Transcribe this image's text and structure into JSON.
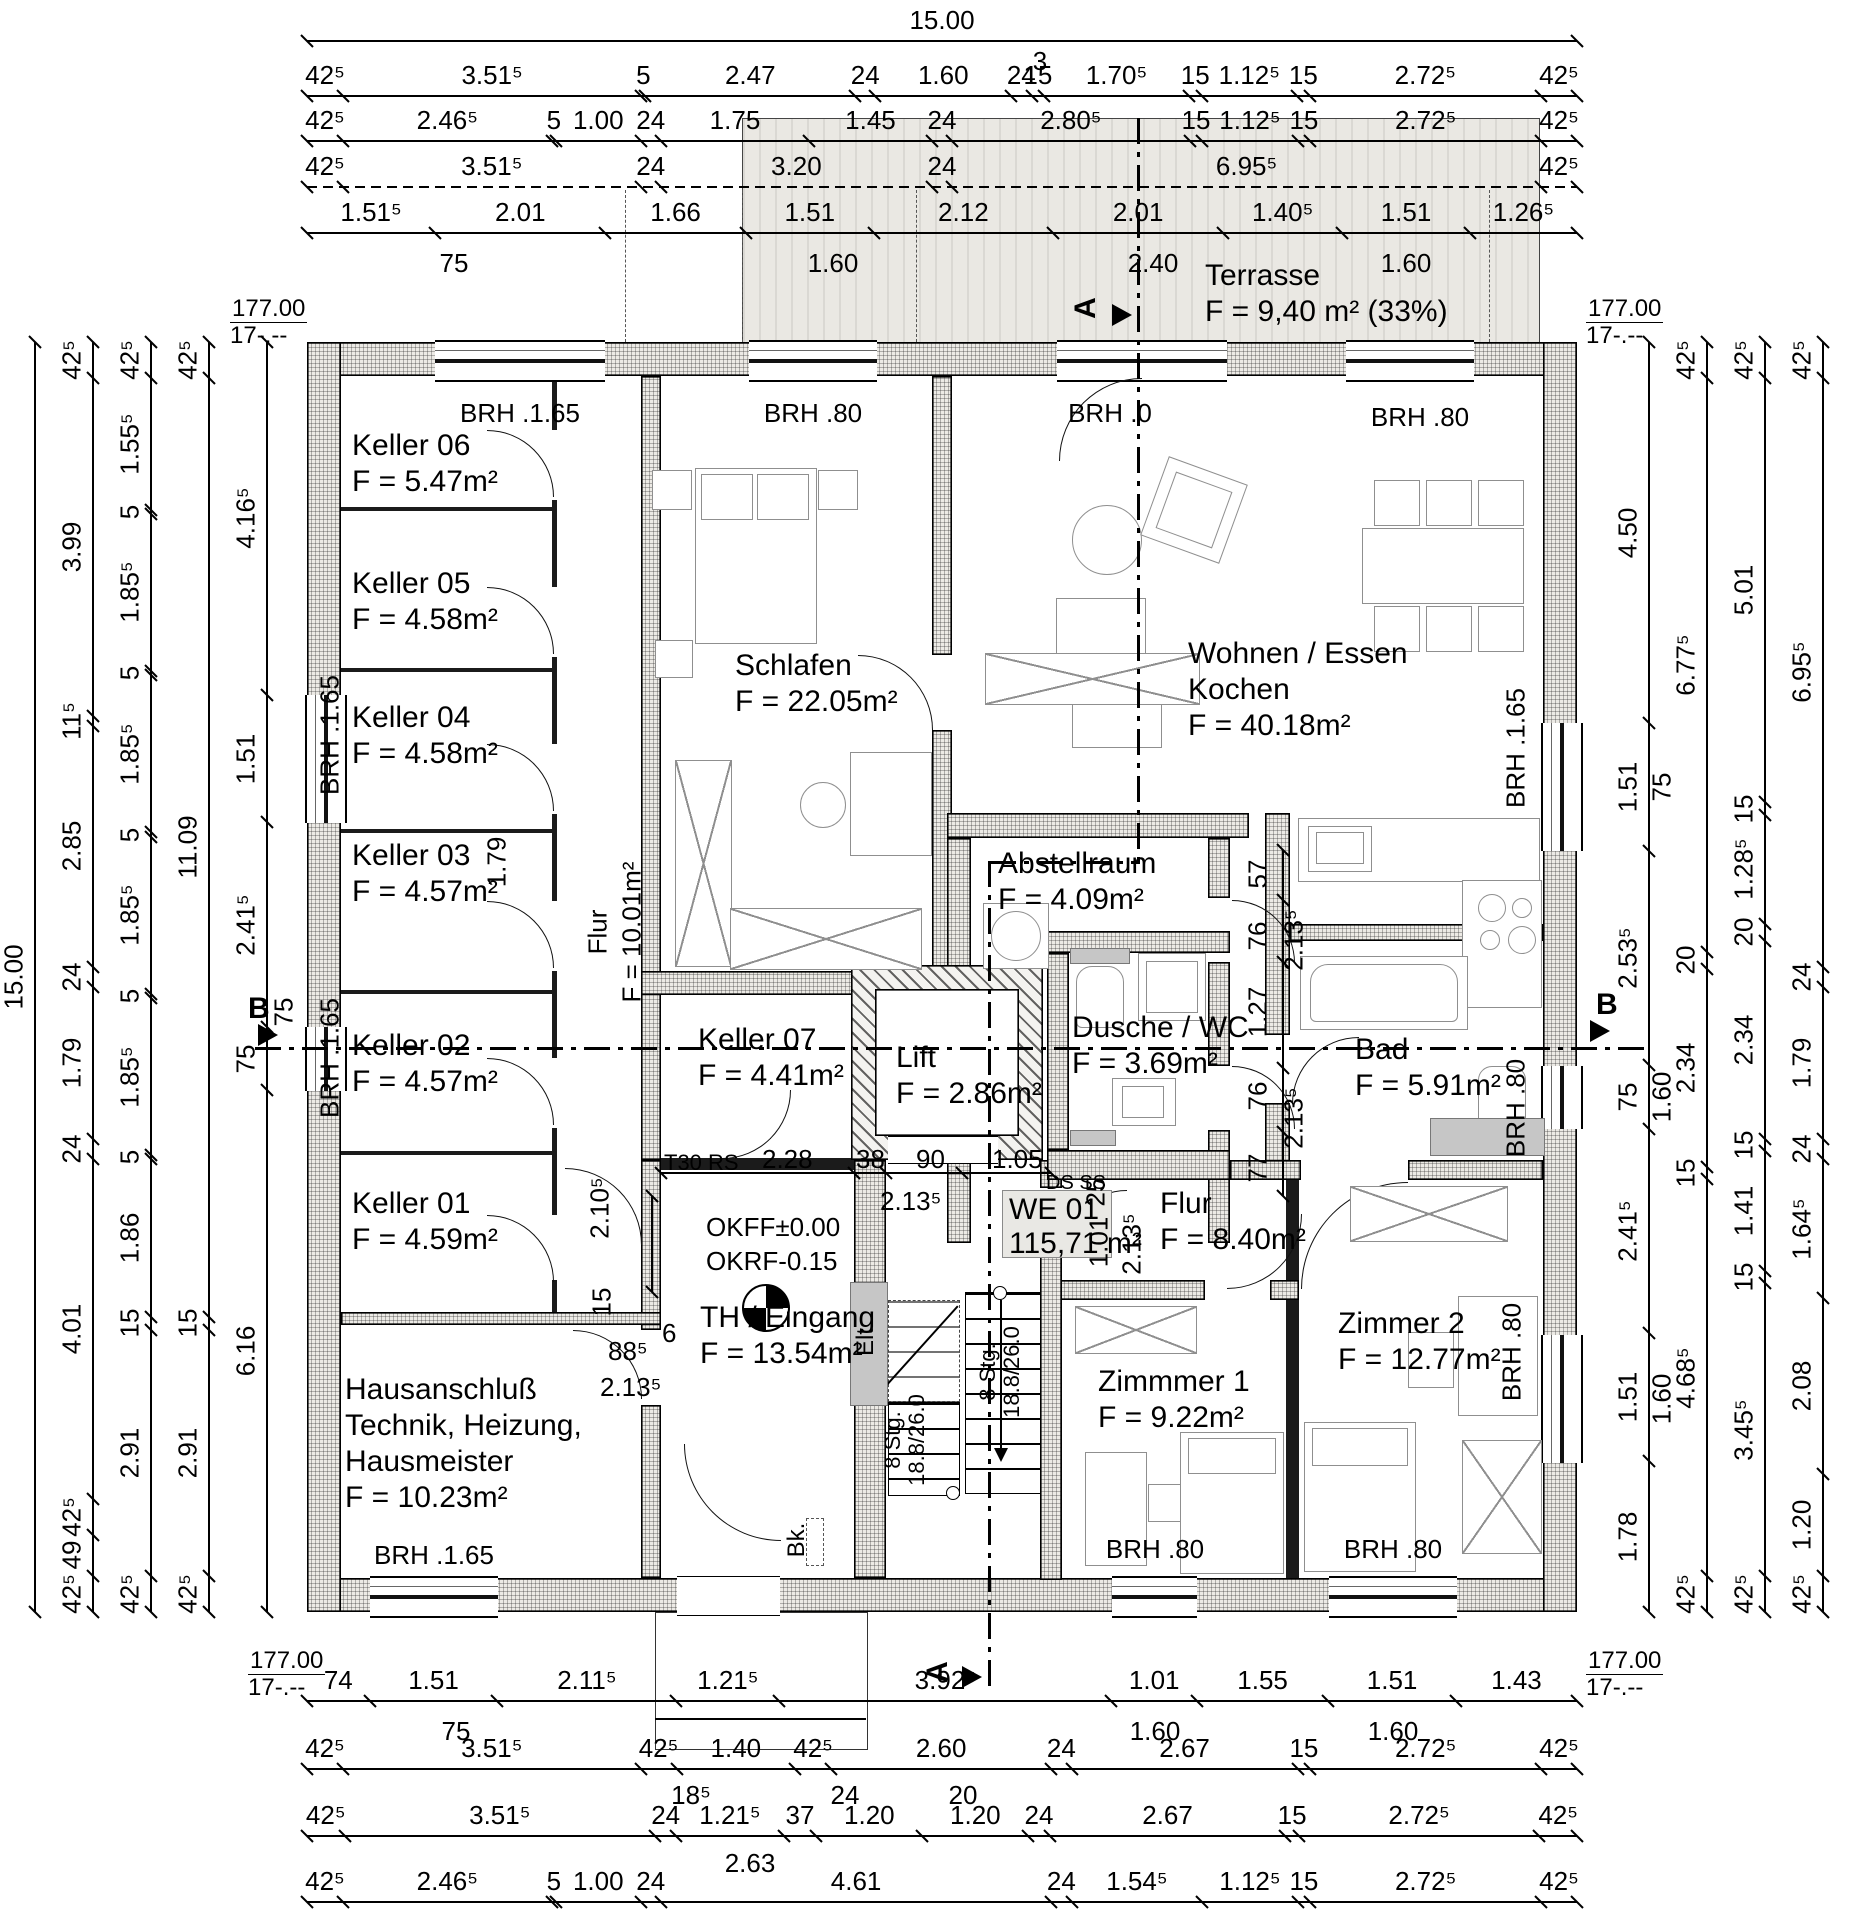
{
  "title": "Grundriss Erdgeschoss WE 01",
  "apartment_box": {
    "lines": [
      "WE 01",
      "115,71 m²"
    ]
  },
  "rooms": [
    {
      "id": "keller06",
      "lines": [
        "Keller 06",
        "F = 5.47m²"
      ],
      "x": 352,
      "y": 428
    },
    {
      "id": "keller05",
      "lines": [
        "Keller 05",
        "F = 4.58m²"
      ],
      "x": 352,
      "y": 566
    },
    {
      "id": "keller04",
      "lines": [
        "Keller 04",
        "F = 4.58m²"
      ],
      "x": 352,
      "y": 700
    },
    {
      "id": "keller03",
      "lines": [
        "Keller 03",
        "F = 4.57m²"
      ],
      "x": 352,
      "y": 838
    },
    {
      "id": "keller02",
      "lines": [
        "Keller 02",
        "F = 4.57m²"
      ],
      "x": 352,
      "y": 1028
    },
    {
      "id": "keller01",
      "lines": [
        "Keller 01",
        "F = 4.59m²"
      ],
      "x": 352,
      "y": 1186
    },
    {
      "id": "hausanschluss",
      "lines": [
        "Hausanschluß",
        "Technik, Heizung,",
        "Hausmeister",
        "F = 10.23m²"
      ],
      "x": 345,
      "y": 1372
    },
    {
      "id": "schlafen",
      "lines": [
        "Schlafen",
        "F = 22.05m²"
      ],
      "x": 735,
      "y": 648
    },
    {
      "id": "wohnen",
      "lines": [
        "Wohnen / Essen",
        "Kochen",
        "F = 40.18m²"
      ],
      "x": 1188,
      "y": 636
    },
    {
      "id": "abstellraum",
      "lines": [
        "Abstellraum",
        "F = 4.09m²"
      ],
      "x": 998,
      "y": 846
    },
    {
      "id": "keller07",
      "lines": [
        "Keller 07",
        "F = 4.41m²"
      ],
      "x": 698,
      "y": 1022
    },
    {
      "id": "lift",
      "lines": [
        "Lift",
        "F = 2.86m²"
      ],
      "x": 896,
      "y": 1040
    },
    {
      "id": "dusche",
      "lines": [
        "Dusche / WC",
        "F = 3.69m²"
      ],
      "x": 1072,
      "y": 1010
    },
    {
      "id": "bad",
      "lines": [
        "Bad",
        "F = 5.91m²"
      ],
      "x": 1355,
      "y": 1032
    },
    {
      "id": "flur-we01",
      "lines": [
        "Flur",
        "F = 8.40m²"
      ],
      "x": 1160,
      "y": 1186
    },
    {
      "id": "th-eingang",
      "lines": [
        "TH / Eingang",
        "F = 13.54m²"
      ],
      "x": 700,
      "y": 1300
    },
    {
      "id": "zimmer1",
      "lines": [
        "Zimmmer 1",
        "F = 9.22m²"
      ],
      "x": 1098,
      "y": 1364
    },
    {
      "id": "zimmer2",
      "lines": [
        "Zimmer 2",
        "F = 12.77m²"
      ],
      "x": 1338,
      "y": 1306
    },
    {
      "id": "terrasse",
      "lines": [
        "Terrasse",
        "F = 9,40 m² (33%)"
      ],
      "x": 1205,
      "y": 258
    }
  ],
  "chains": [
    {
      "id": "top-total",
      "dir": "h",
      "pos": 40,
      "labels": [
        "15.00"
      ]
    },
    {
      "id": "top-row2",
      "dir": "h",
      "pos": 95,
      "labels": [
        "42⁵",
        "3.51⁵",
        "5",
        "2.47",
        "24",
        "1.60",
        "24",
        "15",
        "1.70⁵",
        "15",
        "1.12⁵",
        "15",
        "2.72⁵",
        "42⁵"
      ]
    },
    {
      "id": "top-row3",
      "dir": "h",
      "pos": 140,
      "labels": [
        "42⁵",
        "2.46⁵",
        "5",
        "1.00",
        "24",
        "1.75",
        "1.45",
        "24",
        "2.80⁵",
        "15",
        "1.12⁵",
        "15",
        "2.72⁵",
        "42⁵"
      ]
    },
    {
      "id": "top-row4",
      "dir": "h",
      "pos": 186,
      "dashed": true,
      "labels": [
        "42⁵",
        "3.51⁵",
        "24",
        "3.20",
        "24",
        "6.95⁵",
        "42⁵"
      ]
    },
    {
      "id": "top-row5",
      "dir": "h",
      "pos": 232,
      "labels": [
        "1.51⁵",
        "2.01",
        "1.66",
        "1.51",
        "2.12",
        "2.01",
        "1.40⁵",
        "1.51",
        "1.26⁵"
      ]
    },
    {
      "id": "bottom-row1",
      "dir": "h",
      "pos": 1700,
      "labels": [
        "74",
        "1.51",
        "2.11⁵",
        "1.21⁵",
        "3.92⁵",
        "1.01",
        "1.55",
        "1.51",
        "1.43"
      ]
    },
    {
      "id": "bottom-row2",
      "dir": "h",
      "pos": 1768,
      "labels": [
        "42⁵",
        "3.51⁵",
        "42⁵",
        "1.40",
        "42⁵",
        "2.60",
        "24",
        "2.67",
        "15",
        "2.72⁵",
        "42⁵"
      ]
    },
    {
      "id": "bottom-row3",
      "dir": "h",
      "pos": 1835,
      "labels": [
        "42⁵",
        "3.51⁵",
        "24",
        "1.21⁵",
        "37",
        "1.20",
        "1.20",
        "24",
        "2.67",
        "15",
        "2.72⁵",
        "42⁵"
      ]
    },
    {
      "id": "bottom-row4",
      "dir": "h",
      "pos": 1901,
      "labels": [
        "42⁵",
        "2.46⁵",
        "5",
        "1.00",
        "24",
        "4.61",
        "24",
        "1.54⁵",
        "1.12⁵",
        "15",
        "2.72⁵",
        "42⁵"
      ]
    },
    {
      "id": "left-total",
      "dir": "v",
      "pos": 34,
      "labels": [
        "15.00"
      ]
    },
    {
      "id": "left-row2",
      "dir": "v",
      "pos": 92,
      "labels": [
        "42⁵",
        "3.99",
        "11⁵",
        "2.85",
        "24",
        "1.79",
        "24",
        "4.01",
        "42⁵",
        "49",
        "42⁵"
      ]
    },
    {
      "id": "left-row3",
      "dir": "v",
      "pos": 150,
      "labels": [
        "42⁵",
        "1.55⁵",
        "5",
        "1.85⁵",
        "5",
        "1.85⁵",
        "5",
        "1.85⁵",
        "5",
        "1.85⁵",
        "5",
        "1.86",
        "15",
        "2.91",
        "42⁵"
      ]
    },
    {
      "id": "left-row4",
      "dir": "v",
      "pos": 208,
      "labels": [
        "42⁵",
        "11.09",
        "15",
        "2.91",
        "42⁵"
      ]
    },
    {
      "id": "left-row5",
      "dir": "v",
      "pos": 266,
      "labels": [
        "4.16⁵",
        "1.51",
        "2.41⁵",
        "75",
        "6.16"
      ]
    },
    {
      "id": "right-row1",
      "dir": "v",
      "pos": 1648,
      "labels": [
        "4.50",
        "1.51",
        "2.53⁵",
        "75",
        "2.41⁵",
        "1.51",
        "1.78"
      ]
    },
    {
      "id": "right-row2",
      "dir": "v",
      "pos": 1706,
      "labels": [
        "42⁵",
        "6.77⁵",
        "20",
        "2.34",
        "15",
        "4.68⁵",
        "42⁵"
      ]
    },
    {
      "id": "right-row3",
      "dir": "v",
      "pos": 1764,
      "labels": [
        "42⁵",
        "5.01",
        "15",
        "1.28⁵",
        "20",
        "2.34",
        "15",
        "1.41",
        "15",
        "3.45⁵",
        "42⁵"
      ]
    },
    {
      "id": "right-row4",
      "dir": "v",
      "pos": 1822,
      "labels": [
        "42⁵",
        "6.95⁵",
        "24",
        "1.79",
        "24",
        "1.64⁵",
        "2.08",
        "1.20",
        "42⁵"
      ]
    }
  ],
  "brh_labels": [
    {
      "t": "BRH .1.65",
      "x": 520,
      "y": 398,
      "c": 1
    },
    {
      "t": "BRH .80",
      "x": 813,
      "y": 398,
      "c": 1
    },
    {
      "t": "BRH .0",
      "x": 1110,
      "y": 398,
      "c": 1
    },
    {
      "t": "BRH .80",
      "x": 1420,
      "y": 402,
      "c": 1
    },
    {
      "t": "BRH .1.65",
      "x": 330,
      "y": 735,
      "r": 1
    },
    {
      "t": "BRH .1.65",
      "x": 330,
      "y": 1058,
      "r": 1
    },
    {
      "t": "BRH .1.65",
      "x": 1516,
      "y": 748,
      "r": 1
    },
    {
      "t": "BRH .80",
      "x": 1516,
      "y": 1108,
      "r": 1
    },
    {
      "t": "BRH .80",
      "x": 1512,
      "y": 1352,
      "r": 1
    },
    {
      "t": "BRH .1.65",
      "x": 434,
      "y": 1540,
      "c": 1
    },
    {
      "t": "BRH .80",
      "x": 1155,
      "y": 1534,
      "c": 1
    },
    {
      "t": "BRH .80",
      "x": 1393,
      "y": 1534,
      "c": 1
    }
  ],
  "annotations": [
    {
      "t": "3",
      "x": 1040,
      "y": 46,
      "c": 1
    },
    {
      "t": "75",
      "x": 454,
      "y": 248,
      "c": 1
    },
    {
      "t": "1.60",
      "x": 833,
      "y": 248,
      "c": 1
    },
    {
      "t": "2.40",
      "x": 1153,
      "y": 248,
      "c": 1
    },
    {
      "t": "1.60",
      "x": 1406,
      "y": 248,
      "c": 1
    },
    {
      "t": "75",
      "x": 456,
      "y": 1716,
      "c": 1
    },
    {
      "t": "1.60",
      "x": 1155,
      "y": 1716,
      "c": 1
    },
    {
      "t": "1.60",
      "x": 1393,
      "y": 1716,
      "c": 1
    },
    {
      "t": "18⁵",
      "x": 691,
      "y": 1780,
      "c": 1
    },
    {
      "t": "24",
      "x": 845,
      "y": 1780,
      "c": 1
    },
    {
      "t": "20",
      "x": 963,
      "y": 1780,
      "c": 1
    },
    {
      "t": "2.63",
      "x": 750,
      "y": 1848,
      "c": 1
    },
    {
      "t": "T30 RS",
      "x": 664,
      "y": 1150,
      "s": 22
    },
    {
      "t": "2.28",
      "x": 762,
      "y": 1144
    },
    {
      "t": "38",
      "x": 856,
      "y": 1144
    },
    {
      "t": "90",
      "x": 916,
      "y": 1144
    },
    {
      "t": "1.05",
      "x": 992,
      "y": 1144
    },
    {
      "t": "2.13⁵",
      "x": 880,
      "y": 1186
    },
    {
      "t": "DS SS",
      "x": 1046,
      "y": 1172,
      "s": 20
    },
    {
      "t": "OKFF±0.00",
      "x": 706,
      "y": 1212
    },
    {
      "t": "OKRF-0.15",
      "x": 706,
      "y": 1246
    },
    {
      "t": "2.10⁵",
      "x": 600,
      "y": 1208,
      "r": 1
    },
    {
      "t": "15",
      "x": 602,
      "y": 1302,
      "r": 1
    },
    {
      "t": "88⁵",
      "x": 608,
      "y": 1336
    },
    {
      "t": "6",
      "x": 662,
      "y": 1318
    },
    {
      "t": "2.13⁵",
      "x": 600,
      "y": 1372
    },
    {
      "t": "1.79",
      "x": 497,
      "y": 862,
      "r": 1
    },
    {
      "t": "Flur",
      "x": 598,
      "y": 932,
      "r": 1
    },
    {
      "t": "F = 10.01m²",
      "x": 632,
      "y": 932,
      "r": 1
    },
    {
      "t": "25",
      "x": 1096,
      "y": 1192,
      "r": 1
    },
    {
      "t": "1.01",
      "x": 1099,
      "y": 1242,
      "r": 1
    },
    {
      "t": "2.13⁵",
      "x": 1132,
      "y": 1244,
      "r": 1
    },
    {
      "t": "57",
      "x": 1258,
      "y": 874,
      "r": 1
    },
    {
      "t": "76",
      "x": 1258,
      "y": 936,
      "r": 1
    },
    {
      "t": "1.27",
      "x": 1258,
      "y": 1012,
      "r": 1
    },
    {
      "t": "76",
      "x": 1258,
      "y": 1096,
      "r": 1
    },
    {
      "t": "77",
      "x": 1258,
      "y": 1168,
      "r": 1
    },
    {
      "t": "2.13⁵",
      "x": 1294,
      "y": 940,
      "r": 1
    },
    {
      "t": "2.13⁵",
      "x": 1294,
      "y": 1118,
      "r": 1
    },
    {
      "t": "75",
      "x": 284,
      "y": 1012,
      "r": 1
    },
    {
      "t": "75",
      "x": 1662,
      "y": 787,
      "r": 1
    },
    {
      "t": "1.60",
      "x": 1662,
      "y": 1097,
      "r": 1
    },
    {
      "t": "1.60",
      "x": 1662,
      "y": 1399,
      "r": 1
    },
    {
      "t": "Elt",
      "x": 866,
      "y": 1342,
      "r": 1,
      "s": 24
    },
    {
      "t": "Bk.",
      "x": 797,
      "y": 1540,
      "r": 1,
      "s": 24
    },
    {
      "t": "8 Stg.",
      "x": 893,
      "y": 1440,
      "r": 1,
      "s": 22
    },
    {
      "t": "18.8/26.0",
      "x": 917,
      "y": 1440,
      "r": 1,
      "s": 22
    },
    {
      "t": "8 Stg.",
      "x": 988,
      "y": 1372,
      "r": 1,
      "s": 22
    },
    {
      "t": "18.8/26.0",
      "x": 1012,
      "y": 1372,
      "r": 1,
      "s": 22
    }
  ],
  "section_markers": [
    {
      "t": "A",
      "x": 1086,
      "y": 308,
      "r": 1,
      "tri": "right",
      "tx": 1112,
      "ty": 304
    },
    {
      "t": "A",
      "x": 938,
      "y": 1672,
      "r": 1,
      "tri": "right",
      "tx": 962,
      "ty": 1666
    },
    {
      "t": "B",
      "x": 248,
      "y": 992,
      "tri": "rightup",
      "tx": 258,
      "ty": 1024
    },
    {
      "t": "B",
      "x": 1596,
      "y": 988,
      "tri": "rightup",
      "tx": 1590,
      "ty": 1020
    }
  ],
  "elevation_markers": [
    {
      "l1": "177.00",
      "l2": "17-.--",
      "x": 230,
      "y": 296
    },
    {
      "l1": "177.00",
      "l2": "17-.--",
      "x": 1586,
      "y": 296
    },
    {
      "l1": "177.00",
      "l2": "17-.--",
      "x": 248,
      "y": 1648
    },
    {
      "l1": "177.00",
      "l2": "17-.--",
      "x": 1586,
      "y": 1648
    }
  ]
}
